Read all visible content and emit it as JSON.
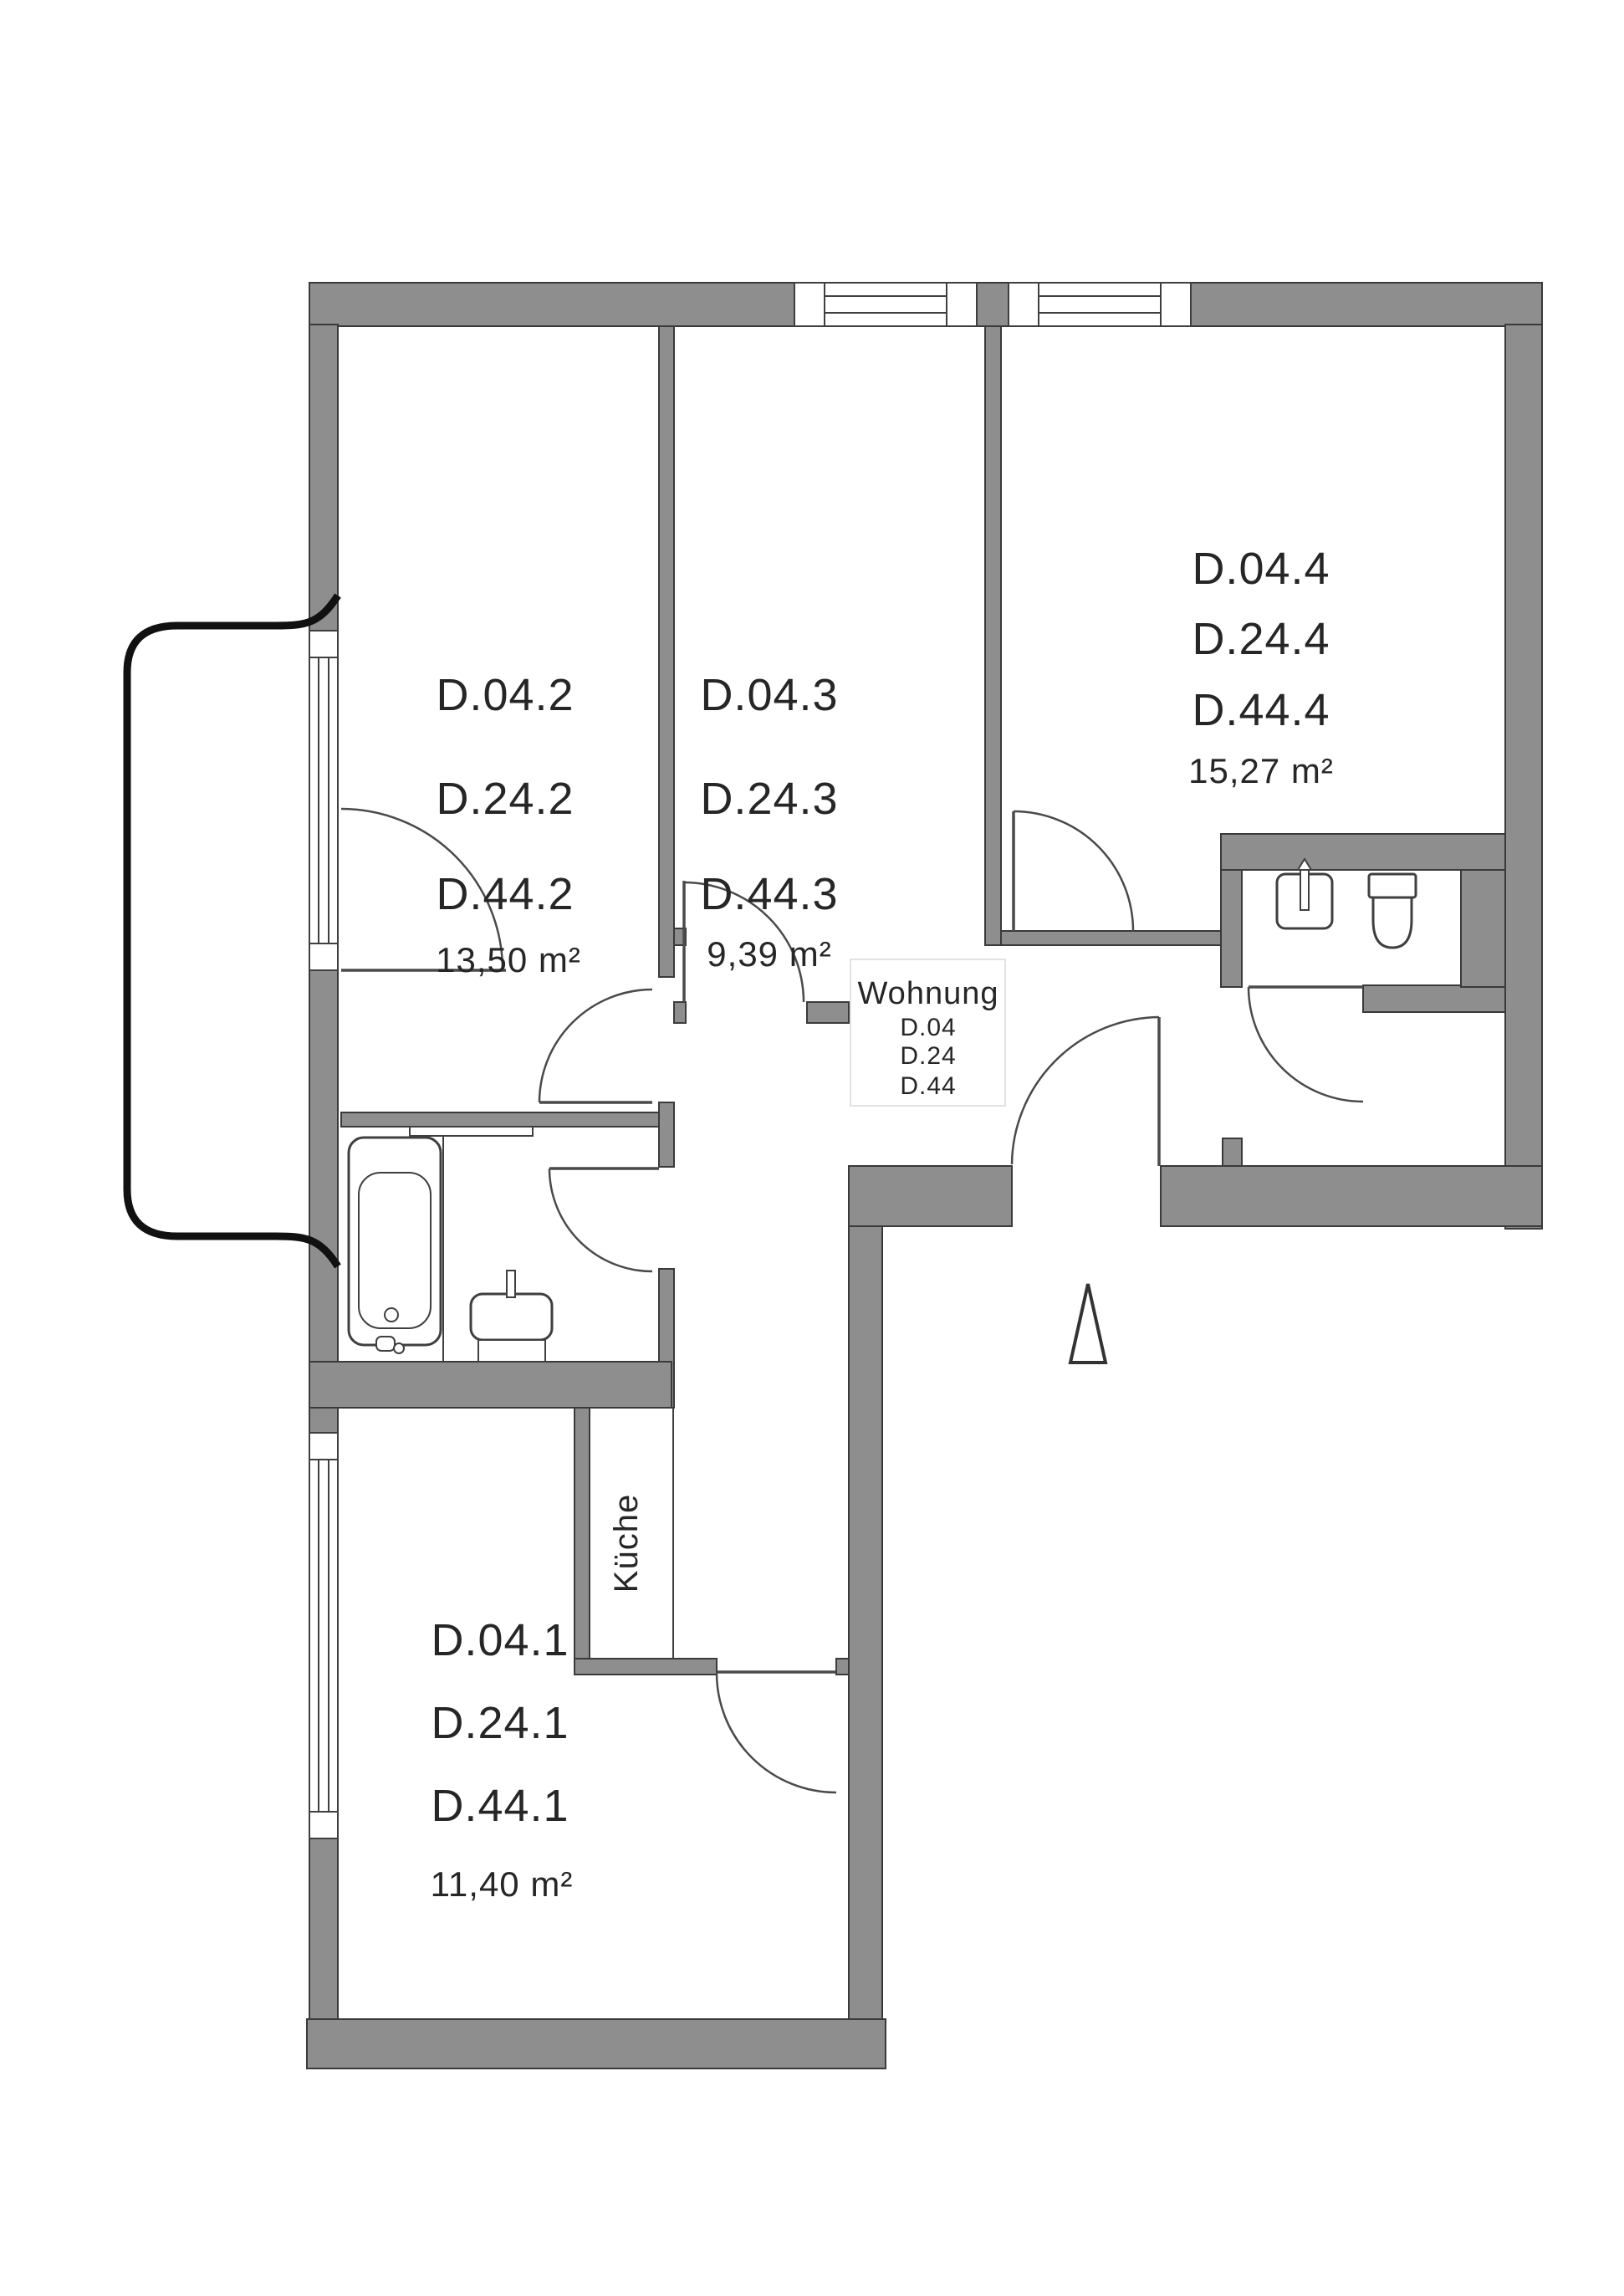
{
  "colors": {
    "wall": "#8e8e8e",
    "wall_outline": "#3a3a3a",
    "door_line": "#4a4a4a",
    "text": "#262626",
    "railing": "#111111",
    "background": "#ffffff",
    "unit_box_border": "#e2e2e2"
  },
  "rooms": {
    "room2": {
      "lines": [
        "D.04.2",
        "D.24.2",
        "D.44.2"
      ],
      "area": "13,50 m²"
    },
    "room3": {
      "lines": [
        "D.04.3",
        "D.24.3",
        "D.44.3"
      ],
      "area": "9,39 m²"
    },
    "room4": {
      "lines": [
        "D.04.4",
        "D.24.4",
        "D.44.4"
      ],
      "area": "15,27 m²"
    },
    "room1": {
      "lines": [
        "D.04.1",
        "D.24.1",
        "D.44.1"
      ],
      "area": "11,40 m²"
    },
    "kitchen": {
      "label": "Küche"
    }
  },
  "unit_box": {
    "title": "Wohnung",
    "lines": [
      "D.04",
      "D.24",
      "D.44"
    ]
  }
}
